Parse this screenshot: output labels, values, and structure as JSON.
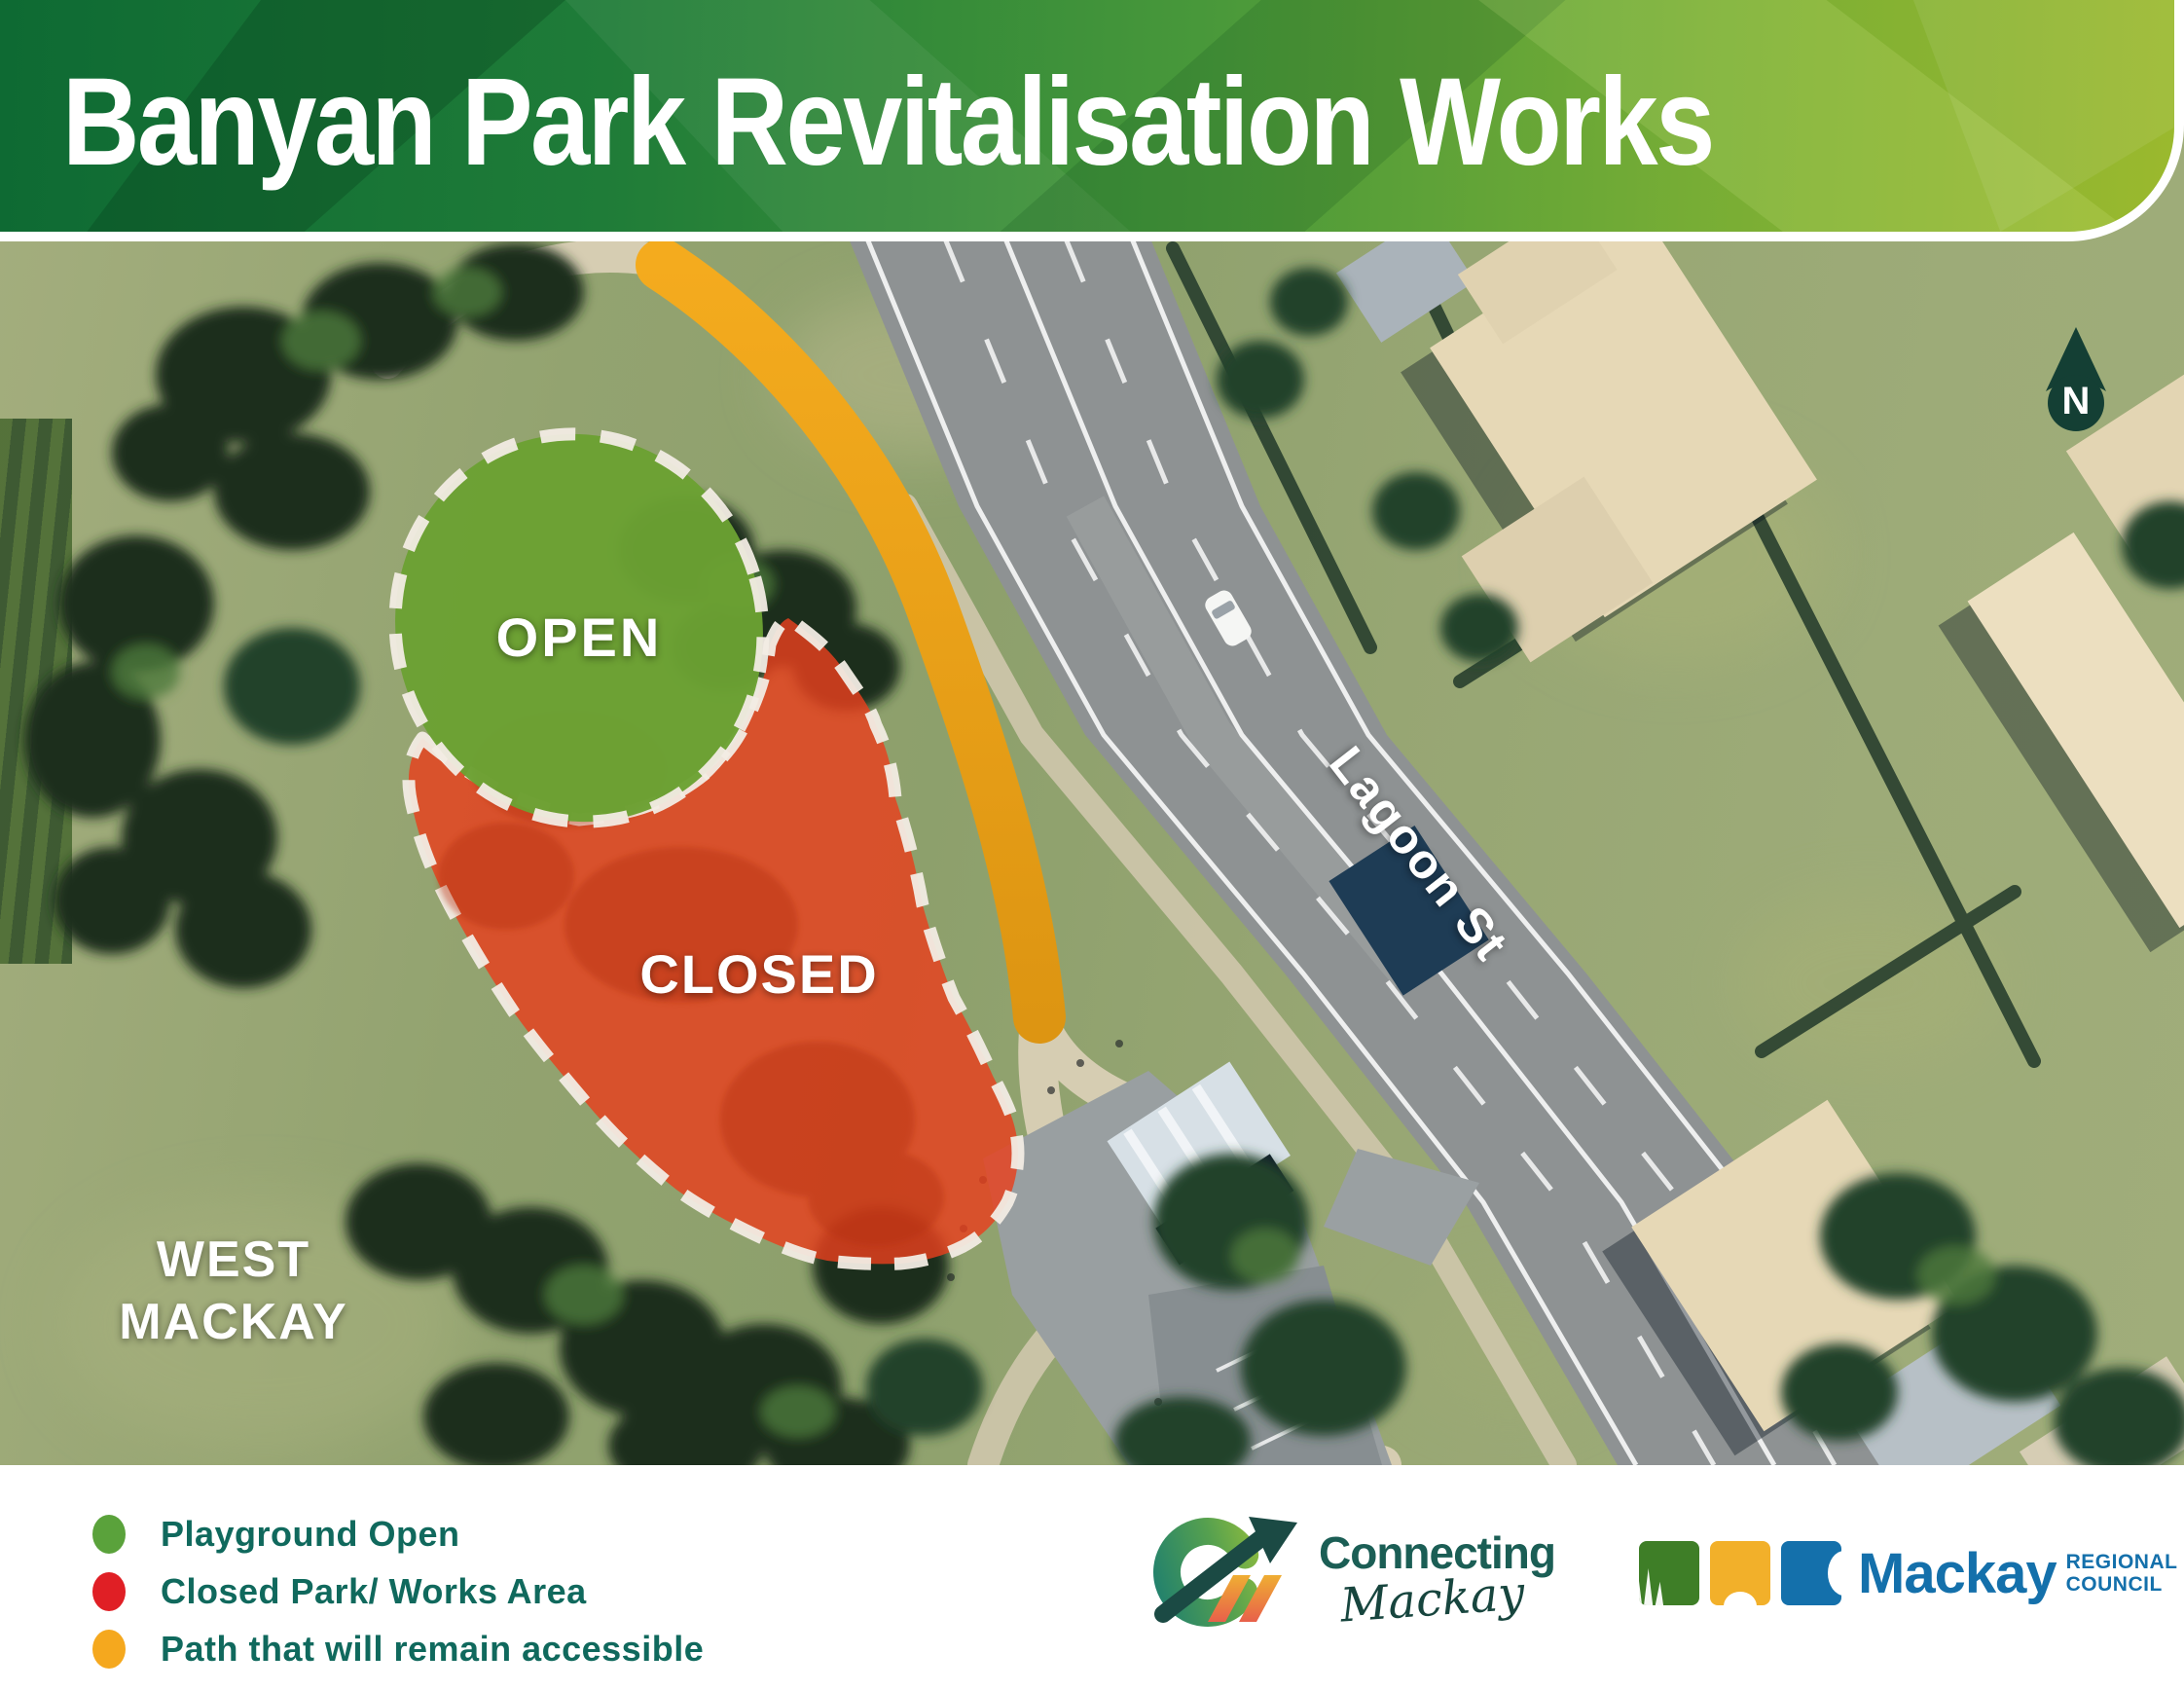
{
  "header": {
    "title": "Banyan Park Revitalisation Works"
  },
  "map": {
    "area_open_label": "OPEN",
    "area_closed_label": "CLOSED",
    "street_label": "Lagoon St",
    "suburb_label_line1": "WEST",
    "suburb_label_line2": "MACKAY",
    "compass_label": "N"
  },
  "legend": {
    "items": [
      {
        "id": "playground-open",
        "color": "#5aa23b",
        "label": "Playground Open"
      },
      {
        "id": "closed-works",
        "color": "#e01f25",
        "label": "Closed Park/ Works Area"
      },
      {
        "id": "path-accessible",
        "color": "#f5a81e",
        "label": "Path that will remain accessible"
      }
    ]
  },
  "logos": {
    "connecting_mackay": {
      "line1": "Connecting",
      "line2": "Mackay"
    },
    "council": {
      "name": "Mackay",
      "sub_line1": "REGIONAL",
      "sub_line2": "COUNCIL"
    }
  },
  "colors": {
    "open_green": "#6ba133",
    "closed_red": "#e8401d",
    "path_yellow": "#f2a51c",
    "header_green_dark": "#0e6a33",
    "header_green_light": "#9bb92e",
    "legend_text_teal": "#10695d",
    "council_blue": "#1470ab",
    "connecting_teal": "#1b5e55",
    "compass_teal": "#143f34"
  }
}
